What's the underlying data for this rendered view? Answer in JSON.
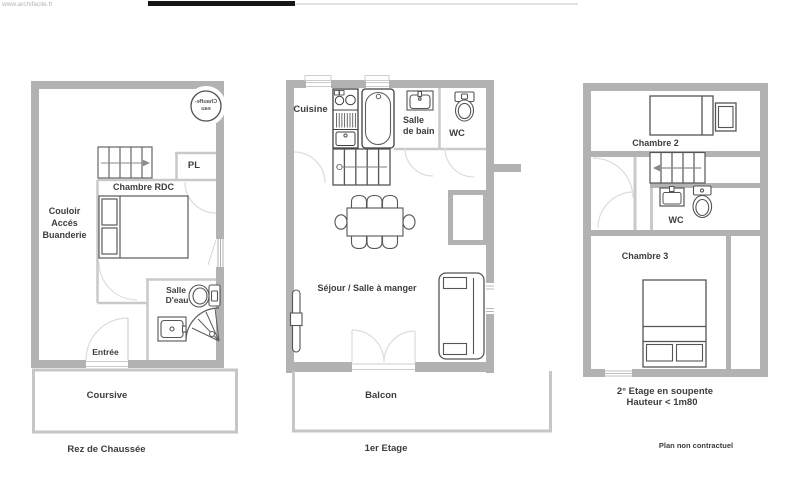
{
  "watermark": "www.archifacile.fr",
  "ground": {
    "title": "Rez de Chaussée",
    "chauffe_eau_line1": "Chauffe-",
    "chauffe_eau_line2": "eau",
    "chambre": "Chambre RDC",
    "pl": "PL",
    "couloir_line1": "Couloir",
    "couloir_line2": "Accés",
    "couloir_line3": "Buanderie",
    "salle_eau_line1": "Salle",
    "salle_eau_line2": "D'eau",
    "entree": "Entrée",
    "coursive": "Coursive"
  },
  "first": {
    "title": "1er Etage",
    "cuisine": "Cuisine",
    "salle_de_bain_line1": "Salle",
    "salle_de_bain_line2": "de bain",
    "wc": "WC",
    "sejour": "Séjour / Salle à manger",
    "balcon": "Balcon"
  },
  "second": {
    "title": "2° Etage en soupente",
    "subtitle": "Hauteur < 1m80",
    "chambre2": "Chambre 2",
    "wc": "WC",
    "chambre3": "Chambre 3"
  },
  "footer": "Plan non contractuel",
  "colors": {
    "wall": "#b2b2b2",
    "thin_wall": "#c9c9c9",
    "furniture": "#4d4d4d",
    "door_arc": "#dcdcdc",
    "text": "#3d3d3d"
  }
}
